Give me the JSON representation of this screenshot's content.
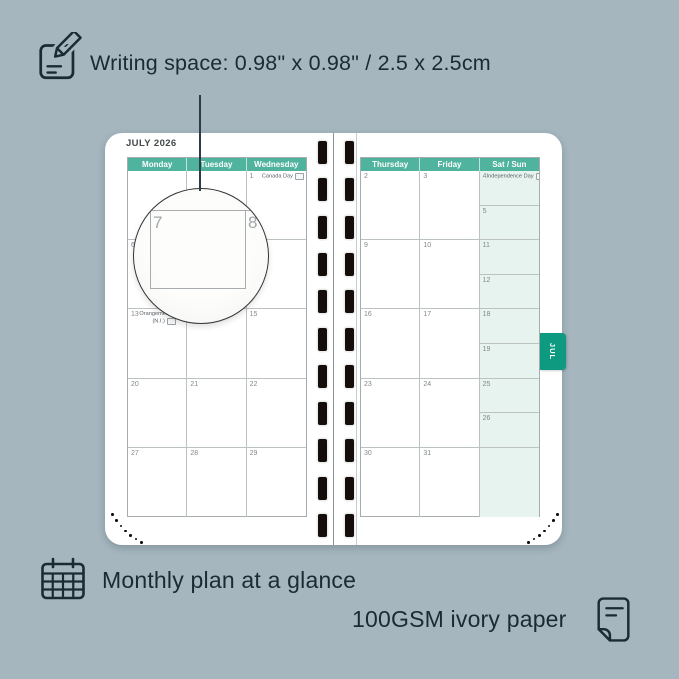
{
  "colors": {
    "background": "#a5b6bf",
    "ink": "#1c2a33",
    "title": "#43484b",
    "teal_header": "#4fb39e",
    "teal_tab": "#0e9a80",
    "weekend_fill": "#e7f3ee",
    "grid": "#bcc1c2",
    "table_border": "#a7adaf",
    "date": "#82888c",
    "holiday": "#5a6165",
    "slot": "#150d09",
    "paper": "#ffffff",
    "circle_line": "#a7acae",
    "magnified_digit": "#a2a7aa"
  },
  "callouts": {
    "writing_space": "Writing space: 0.98\" x 0.98\" / 2.5 x 2.5cm",
    "monthly_plan": "Monthly plan at a glance",
    "paper_quality": "100GSM ivory paper"
  },
  "icons": {
    "top_left": "note-pencil-icon",
    "bottom_left": "calendar-grid-icon",
    "bottom_right": "paper-sheet-icon"
  },
  "planner": {
    "month_title": "JULY 2026",
    "month_tab": "JUL",
    "left_page": {
      "day_headers": [
        "Monday",
        "Tuesday",
        "Wednesday"
      ],
      "weeks": [
        [
          {
            "date": ""
          },
          {
            "date": ""
          },
          {
            "date": "1",
            "holiday": "Canada Day",
            "badge": true
          }
        ],
        [
          {
            "date": "6"
          },
          {
            "date": ""
          },
          {
            "date": ""
          }
        ],
        [
          {
            "date": "13",
            "holiday": "Orangemen's Day",
            "holiday2": "(N.I.)",
            "badge": true
          },
          {
            "date": ""
          },
          {
            "date": "15"
          }
        ],
        [
          {
            "date": "20"
          },
          {
            "date": "21"
          },
          {
            "date": "22"
          }
        ],
        [
          {
            "date": "27"
          },
          {
            "date": "28"
          },
          {
            "date": "29"
          }
        ]
      ]
    },
    "right_page": {
      "day_headers": [
        "Thursday",
        "Friday",
        "Sat / Sun"
      ],
      "weeks": [
        {
          "thursday": "2",
          "friday": "3",
          "saturday": {
            "date": "4",
            "holiday": "Independence Day",
            "badge": true
          },
          "sunday": {
            "date": "5"
          }
        },
        {
          "thursday": "9",
          "friday": "10",
          "saturday": {
            "date": "11"
          },
          "sunday": {
            "date": "12"
          }
        },
        {
          "thursday": "16",
          "friday": "17",
          "saturday": {
            "date": "18"
          },
          "sunday": {
            "date": "19"
          }
        },
        {
          "thursday": "23",
          "friday": "24",
          "saturday": {
            "date": "25"
          },
          "sunday": {
            "date": "26"
          }
        },
        {
          "thursday": "30",
          "friday": "31",
          "saturday": null,
          "sunday": null
        }
      ]
    },
    "magnifier": {
      "day": "7",
      "next_day": "8"
    }
  }
}
